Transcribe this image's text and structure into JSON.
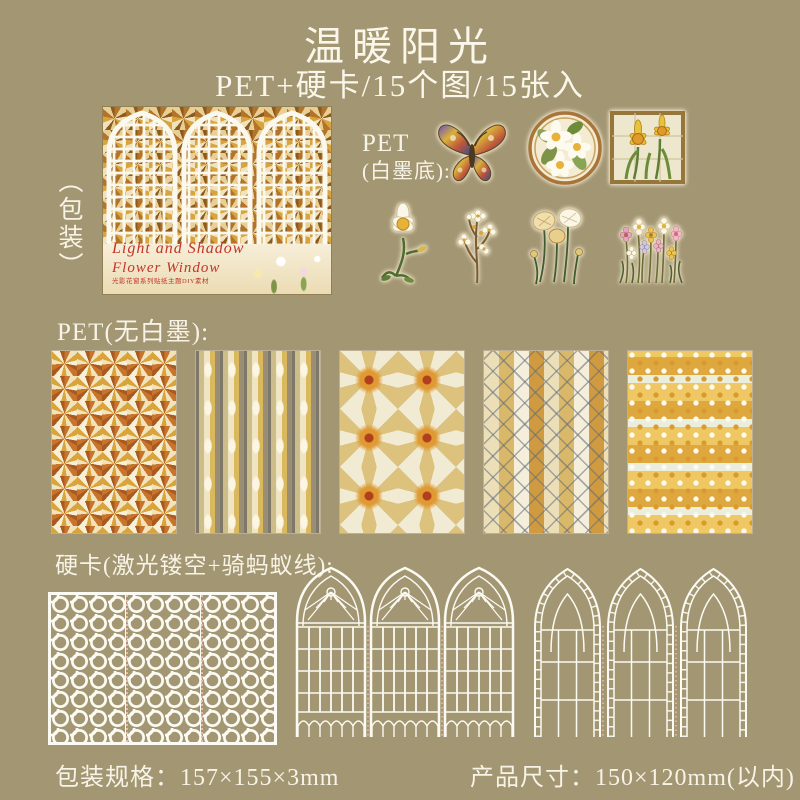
{
  "colors": {
    "background": "#a39673",
    "text": "#f7f3e6",
    "script_red": "#c2342a",
    "lattice_white": "#fcfbf3",
    "ant_line_pink": "#eab9ac"
  },
  "header": {
    "title": "温暖阳光",
    "subtitle": "PET+硬卡/15个图/15张入"
  },
  "package": {
    "side_label": "（包装）",
    "title_en_line1": "Light and Shadow",
    "title_en_line2": "Flower Window",
    "subtext": "光影花窗系列贴纸主题DIY素材"
  },
  "labels": {
    "pet_white_line1": "PET",
    "pet_white_line2": "(白墨底):",
    "pet_clear": "PET(无白墨):",
    "hard_card": "硬卡(激光镂空+骑蚂蚁线):"
  },
  "stickers": {
    "row1": [
      "stained-glass butterfly",
      "round floral medallion",
      "square daffodil panel"
    ],
    "row2": [
      "white daffodil",
      "blossom branch",
      "cream poppies",
      "wildflower bunch"
    ]
  },
  "sheets": {
    "count": 5,
    "style": "gold stained-glass pattern sheets"
  },
  "cards": {
    "count": 3,
    "style": "white laser-cut window hard cards"
  },
  "footer": {
    "package_spec": "包装规格：157×155×3mm",
    "product_size": "产品尺寸：150×120mm(以内)"
  }
}
